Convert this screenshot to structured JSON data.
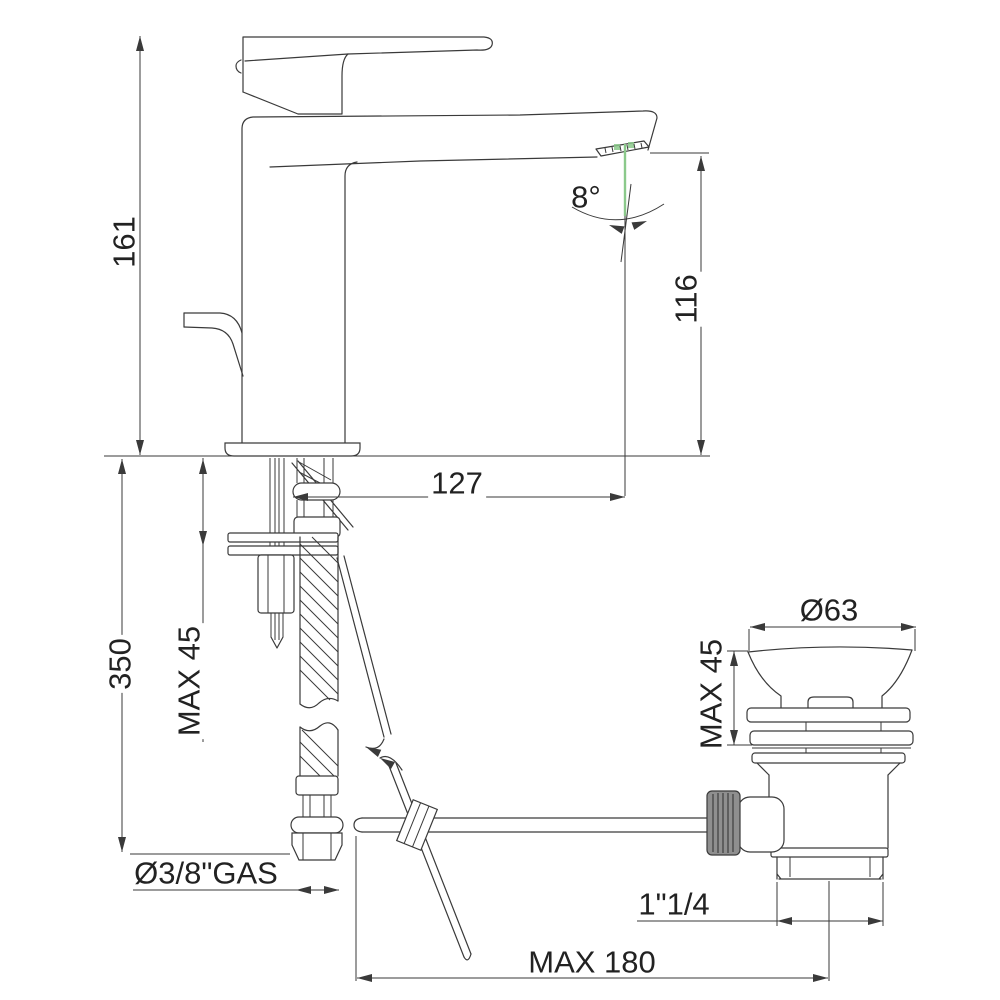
{
  "drawing": {
    "dimensions": {
      "overall_height": "161",
      "spout_height": "116",
      "spout_reach": "127",
      "supply_hose_length": "350",
      "deck_thickness_max": "MAX 45",
      "inlet_thread": "Ø3/8\"GAS",
      "aerator_angle": "8°"
    },
    "waste": {
      "flange_diameter": "Ø63",
      "basin_thickness_max": "MAX 45",
      "outlet_thread": "1\"1/4",
      "rod_length_max": "MAX 180"
    },
    "colors": {
      "line": "#3a3a3a",
      "water": "#8bc98b",
      "knurl": "#8f8f8f"
    }
  }
}
